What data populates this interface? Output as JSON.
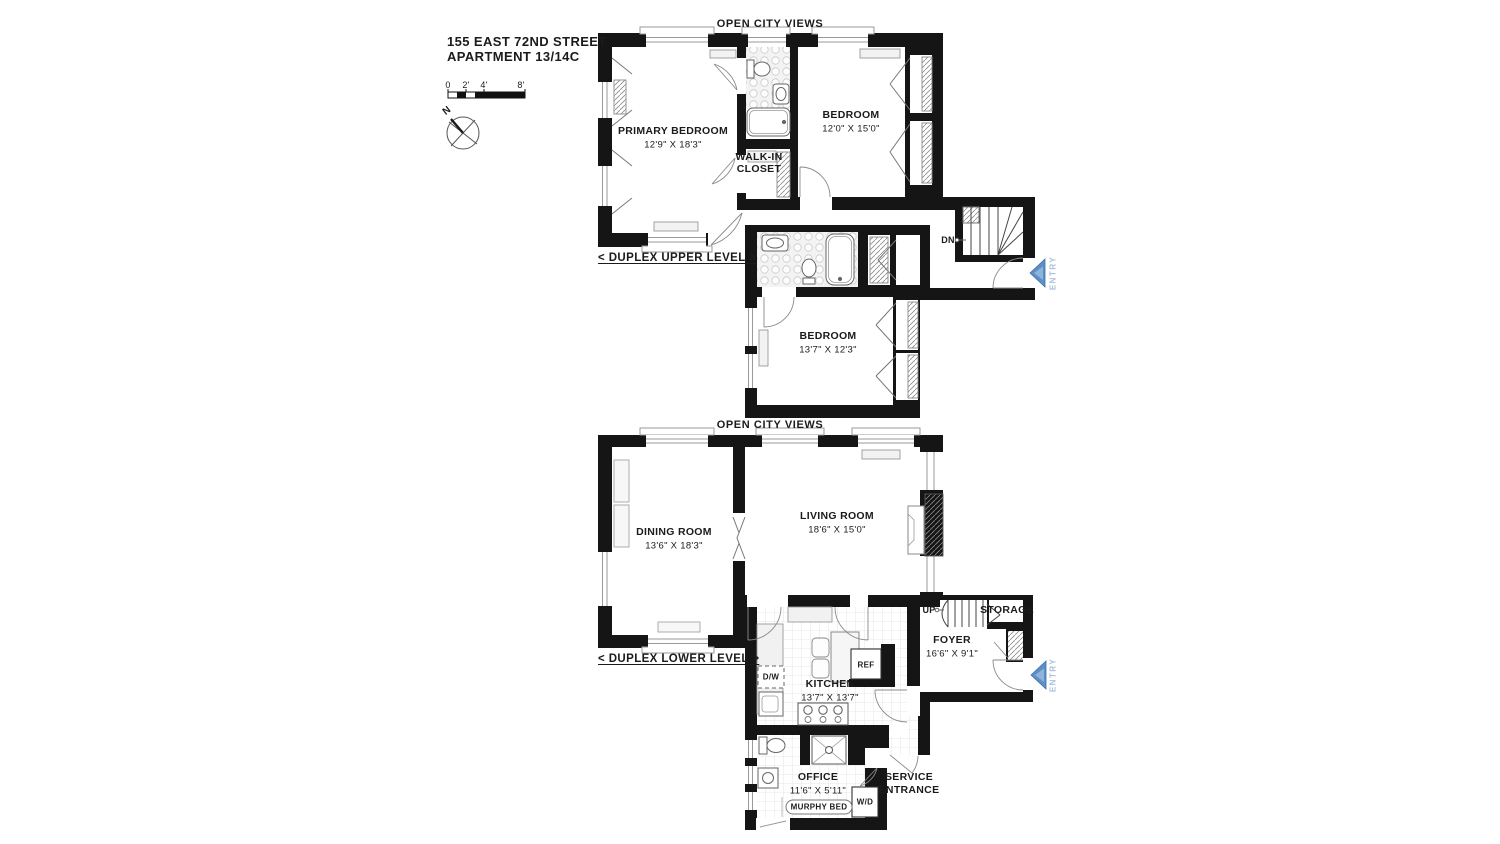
{
  "header": {
    "address_line1": "155 EAST 72ND STREET",
    "address_line2": "APARTMENT 13/14C"
  },
  "scale_bar": {
    "tick_labels": [
      "0",
      "2'",
      "4'",
      "8'"
    ]
  },
  "compass": {
    "north_label": "N"
  },
  "upper_level": {
    "banner": "OPEN CITY VIEWS",
    "level_label": "< DUPLEX UPPER LEVEL >",
    "rooms": {
      "primary_bedroom": {
        "name": "PRIMARY BEDROOM",
        "dims": "12'9\" X 18'3\""
      },
      "bedroom_2": {
        "name": "BEDROOM",
        "dims": "12'0\" X 15'0\""
      },
      "bedroom_3": {
        "name": "BEDROOM",
        "dims": "13'7\" X 12'3\""
      },
      "walk_in_closet": {
        "line1": "WALK-IN",
        "line2": "CLOSET"
      }
    },
    "stairs_label": "DN",
    "entry_label": "ENTRY"
  },
  "lower_level": {
    "banner": "OPEN CITY VIEWS",
    "level_label": "< DUPLEX LOWER LEVEL >",
    "rooms": {
      "dining_room": {
        "name": "DINING ROOM",
        "dims": "13'6\" X 18'3\""
      },
      "living_room": {
        "name": "LIVING ROOM",
        "dims": "18'6\" X 15'0\""
      },
      "kitchen": {
        "name": "KITCHEN",
        "dims": "13'7\" X 13'7\""
      },
      "foyer": {
        "name": "FOYER",
        "dims": "16'6\" X 9'1\""
      },
      "office": {
        "name": "OFFICE",
        "dims": "11'6\" X 5'11\""
      },
      "storage": {
        "name": "STORAGE"
      },
      "service_entrance": {
        "line1": "SERVICE",
        "line2": "ENTRANCE"
      }
    },
    "appliances": {
      "refrigerator": "REF",
      "dishwasher": "D/W",
      "washer_dryer": "W/D",
      "murphy_bed": "MURPHY BED"
    },
    "stairs_label": "UP",
    "entry_label": "ENTRY"
  },
  "colors": {
    "wall": "#151515",
    "entry_arrow": "#5f8fc7",
    "entry_text": "#a9c0da"
  }
}
